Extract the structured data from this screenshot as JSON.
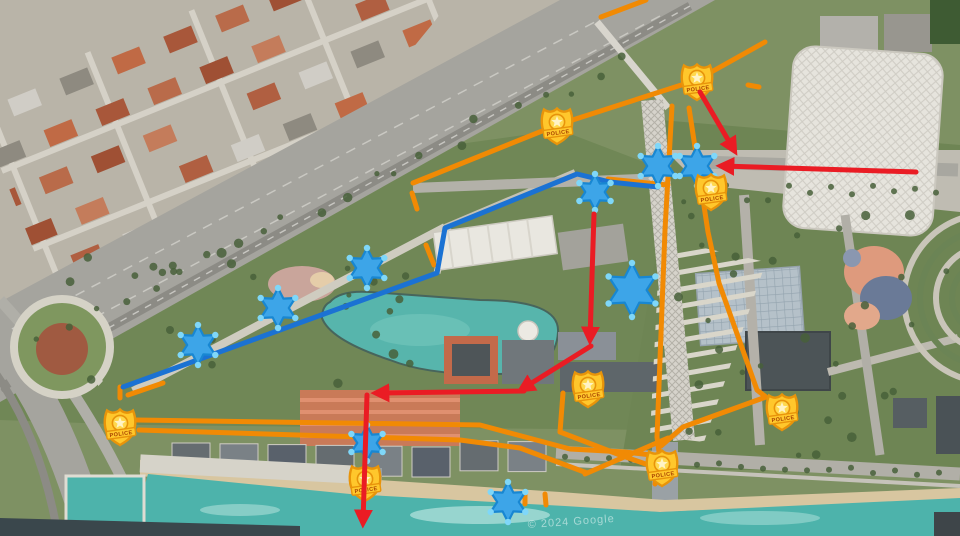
{
  "map": {
    "watermark": "© 2024 Google",
    "badge_label": "POLICE",
    "colors": {
      "route_orange": "#F18A04",
      "route_blue": "#1B72D3",
      "arrow_red": "#EA1C24",
      "star_fill": "#3DA5E8",
      "star_stroke": "#1887D2",
      "star_dot": "#7FD7F9",
      "badge_gold": "#FFC72C",
      "badge_dark": "#E8940A",
      "badge_text": "#A84300",
      "water": "#4DB3AB"
    },
    "stars": [
      {
        "x": 658,
        "y": 166,
        "size": 40
      },
      {
        "x": 697,
        "y": 166,
        "size": 40
      },
      {
        "x": 595,
        "y": 192,
        "size": 36
      },
      {
        "x": 632,
        "y": 290,
        "size": 54
      },
      {
        "x": 367,
        "y": 268,
        "size": 40
      },
      {
        "x": 278,
        "y": 308,
        "size": 40
      },
      {
        "x": 198,
        "y": 345,
        "size": 40
      },
      {
        "x": 367,
        "y": 443,
        "size": 36
      },
      {
        "x": 508,
        "y": 502,
        "size": 40
      }
    ],
    "badges": [
      {
        "x": 697,
        "y": 81
      },
      {
        "x": 557,
        "y": 125
      },
      {
        "x": 711,
        "y": 191
      },
      {
        "x": 120,
        "y": 426
      },
      {
        "x": 588,
        "y": 388
      },
      {
        "x": 782,
        "y": 411
      },
      {
        "x": 662,
        "y": 467
      },
      {
        "x": 365,
        "y": 482
      }
    ],
    "red_arrows": [
      {
        "points": [
          [
            700,
            92
          ],
          [
            734,
            150
          ]
        ]
      },
      {
        "points": [
          [
            916,
            172
          ],
          [
            722,
            166
          ]
        ]
      },
      {
        "points": [
          [
            594,
            214
          ],
          [
            590,
            339
          ]
        ]
      },
      {
        "points": [
          [
            591,
            346
          ],
          [
            522,
            389
          ]
        ]
      },
      {
        "points": [
          [
            524,
            391
          ],
          [
            377,
            393
          ]
        ]
      },
      {
        "points": [
          [
            367,
            395
          ],
          [
            363,
            522
          ]
        ]
      }
    ],
    "blue_routes": [
      {
        "points": [
          [
            658,
            187
          ],
          [
            610,
            182
          ],
          [
            577,
            174
          ],
          [
            445,
            228
          ],
          [
            437,
            273
          ],
          [
            123,
            387
          ]
        ]
      }
    ],
    "orange_routes": [
      {
        "points": [
          [
            765,
            42
          ],
          [
            697,
            80
          ],
          [
            557,
            125
          ],
          [
            413,
            183
          ]
        ]
      },
      {
        "points": [
          [
            672,
            106
          ],
          [
            665,
            230
          ],
          [
            657,
            437
          ],
          [
            659,
            452
          ],
          [
            655,
            484
          ]
        ]
      },
      {
        "points": [
          [
            689,
            108
          ],
          [
            708,
            232
          ],
          [
            719,
            283
          ],
          [
            757,
            390
          ],
          [
            766,
            397
          ],
          [
            683,
            427
          ],
          [
            661,
            446
          ]
        ]
      },
      {
        "points": [
          [
            136,
            420
          ],
          [
            480,
            425
          ],
          [
            570,
            449
          ],
          [
            625,
            452
          ],
          [
            660,
            456
          ]
        ]
      },
      {
        "points": [
          [
            139,
            430
          ],
          [
            460,
            440
          ],
          [
            520,
            448
          ],
          [
            587,
            473
          ]
        ]
      },
      {
        "points": [
          [
            668,
            438
          ],
          [
            585,
            474
          ]
        ]
      },
      {
        "points": [
          [
            608,
            179
          ],
          [
            668,
            185
          ]
        ]
      },
      {
        "points": [
          [
            646,
            0
          ],
          [
            601,
            17
          ]
        ]
      },
      {
        "points": [
          [
            563,
            393
          ],
          [
            560,
            432
          ],
          [
            620,
            455
          ],
          [
            657,
            468
          ]
        ]
      }
    ],
    "orange_dashes": [
      {
        "points": [
          [
            412,
            193
          ],
          [
            417,
            209
          ]
        ]
      },
      {
        "points": [
          [
            426,
            245
          ],
          [
            434,
            265
          ]
        ]
      },
      {
        "points": [
          [
            163,
            383
          ],
          [
            128,
            395
          ]
        ]
      },
      {
        "points": [
          [
            120,
            387
          ],
          [
            120,
            398
          ]
        ]
      },
      {
        "points": [
          [
            748,
            85
          ],
          [
            759,
            87
          ]
        ]
      },
      {
        "points": [
          [
            525,
            494
          ],
          [
            525,
            504
          ]
        ]
      },
      {
        "points": [
          [
            545,
            494
          ],
          [
            546,
            505
          ]
        ]
      }
    ]
  }
}
